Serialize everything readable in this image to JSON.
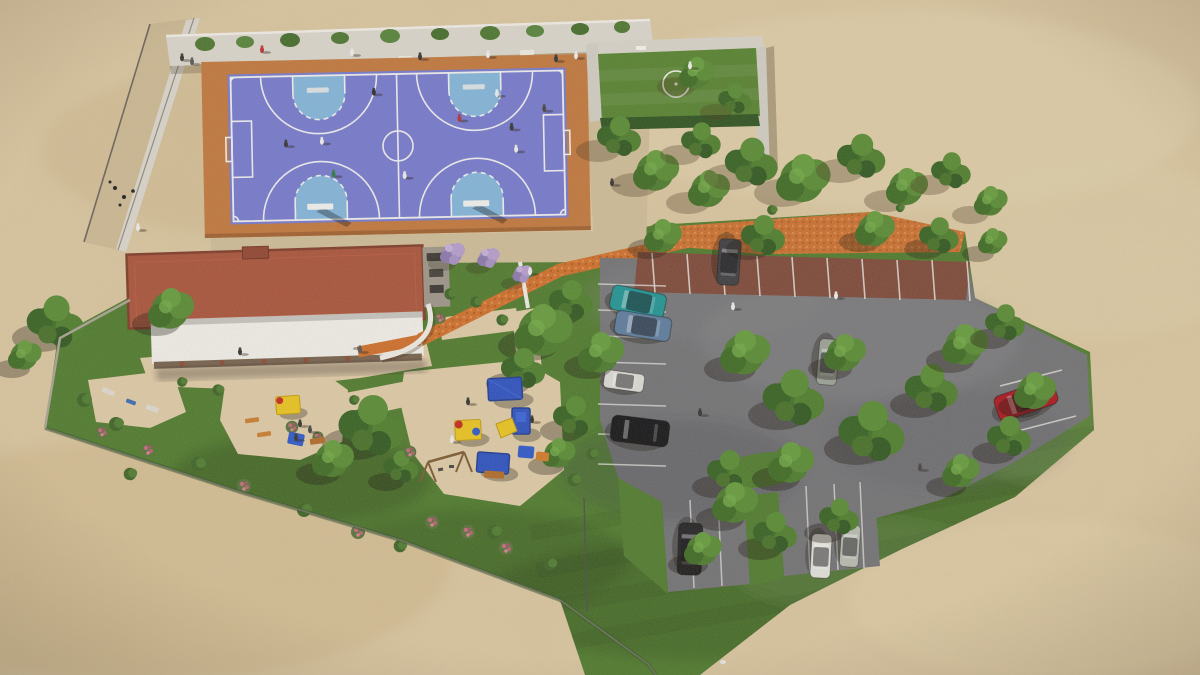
{
  "meta": {
    "title": "Aerial 3D architectural rendering of a community sports park",
    "view": "top-down aerial render, no visible text"
  },
  "palette": {
    "sand": "#d8c49e",
    "walk_sand": "#cdbb97",
    "play_sand": "#dcc9a6",
    "lawn": "#4e7a2d",
    "asphalt": "#717175",
    "apron": "#c0763c",
    "court_purple": "#7478cd",
    "court_blue": "#82b4da",
    "court_line": "#f4f4f2",
    "roof": "#a8523a",
    "canopy": "#efede8",
    "pitch_green": "#55812f",
    "mulch": "#c96f2f",
    "path_orange": "#cd6d2a",
    "wall": "#d9d5cc",
    "bay_brown": "#7c4738",
    "fence": "#67705c",
    "tree_green": "#4a7a2c",
    "red_car": "#a8161f",
    "teal_car": "#1f9393"
  },
  "site": {
    "sports_court": {
      "label": "multi-sport court",
      "surface": [
        "purple field",
        "light-blue basketball keys"
      ],
      "markings": [
        "two cross basketball courts",
        "futsal goal boxes",
        "center circle",
        "dashed free-throw arcs"
      ],
      "players_visible": 10,
      "backboards": 4
    },
    "mini_pitch": {
      "label": "small walled grass pitch",
      "marking": "white center circle"
    },
    "building": {
      "label": "clubhouse with terracotta flat roof and long white canopy"
    },
    "playground": {
      "label": "sand playground",
      "equipment": [
        "blue shade canopies",
        "blue slide tower",
        "yellow slide",
        "swing set",
        "yellow play boxes",
        "orange benches",
        "picnic tables"
      ]
    },
    "parking": {
      "label": "asphalt parking lot",
      "top_row": "red-brown paver bays with white stripes and orange mulch strip",
      "cars": [
        {
          "color": "dark gray",
          "where": "top bay"
        },
        {
          "color": "teal",
          "where": "left bays"
        },
        {
          "color": "steel blue",
          "where": "left bays"
        },
        {
          "color": "white",
          "where": "left bays"
        },
        {
          "color": "black",
          "where": "left bays"
        },
        {
          "color": "silver",
          "where": "center aisle"
        },
        {
          "color": "red convertible",
          "where": "east bay"
        },
        {
          "color": "dark",
          "where": "bottom bays"
        },
        {
          "color": "white",
          "where": "bottom bays"
        },
        {
          "color": "silver",
          "where": "bottom bays"
        }
      ]
    },
    "landscape": {
      "trees_visible": 45,
      "lawn": "grass apron wrapping the parking lot and playground",
      "boundary": "thin fence line on the south-west edge",
      "terrain": "bare sandy ground around the site"
    }
  }
}
